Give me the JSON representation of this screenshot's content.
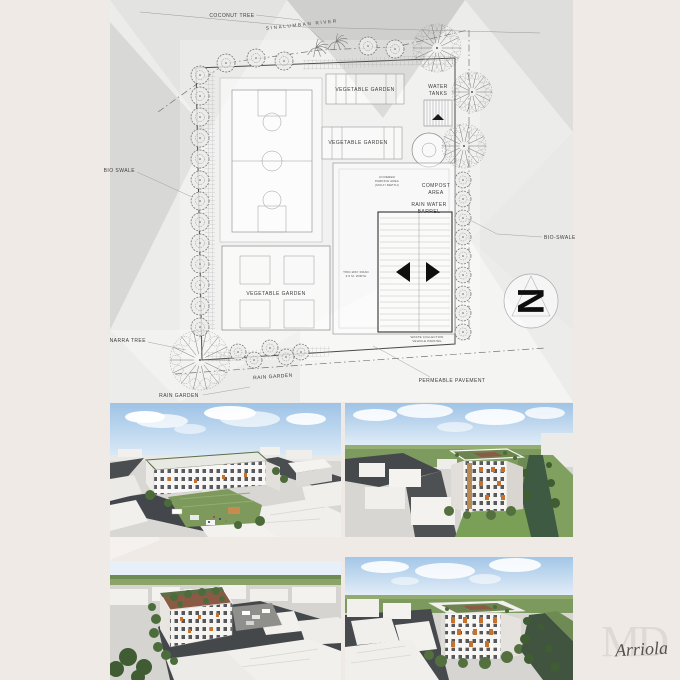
{
  "palette": {
    "paper": "#efeae6",
    "board": "#ececeb",
    "ink": "#3c3c3c",
    "sky": "#9ec3e6",
    "grass": "#7d9a5c",
    "dark_green": "#4d6c3b",
    "river": "#3f5a43",
    "road": "#46494c",
    "massing": "#f3f2ef",
    "massing_side": "#d9d7d3",
    "building_white": "#fafaf8",
    "accent_orange": "#c4722e",
    "roof_green": "#5c6e48",
    "roof_brown": "#8a5a44",
    "signature_ink": "#55504b",
    "watermark": "#ded9d3"
  },
  "site_plan": {
    "labels": {
      "coconut_tree": "COCONUT TREE",
      "river": "SINALUMBAN RIVER",
      "vegetable_garden_top": "VEGETABLE GARDEN",
      "water_tanks_1": "WATER",
      "water_tanks_2": "TANKS",
      "vegetable_garden_mid": "VEGETABLE GARDEN",
      "bio_swale_left": "BIO SWALE",
      "compost_area_1": "COMPOST",
      "compost_area_2": "AREA",
      "rain_water_barrel_1": "RAIN WATER",
      "rain_water_barrel_2": "BARREL",
      "vegetable_garden_bottom": "VEGETABLE GARDEN",
      "bio_swale_right": "BIO-SWALE",
      "narra_tree": "NARRA TREE",
      "rain_garden_row": "RAIN GARDEN",
      "rain_garden_bottom": "RAIN GARDEN",
      "permeable_pavement": "PERMEABLE PAVEMENT",
      "covered_parking_1": "COVERED",
      "covered_parking_2": "PARKING AREA",
      "covered_parking_3": "(MULTI DEPTH)",
      "road_note_1": "TWO-WAY ROAD",
      "road_note_2": "3.5 M. WIDTH",
      "waste_note_1": "WASTE COLLECTION",
      "waste_note_2": "VEHICLE PARKING",
      "north": "N"
    }
  },
  "signature": {
    "watermark": "MD",
    "name": "Arriola"
  }
}
